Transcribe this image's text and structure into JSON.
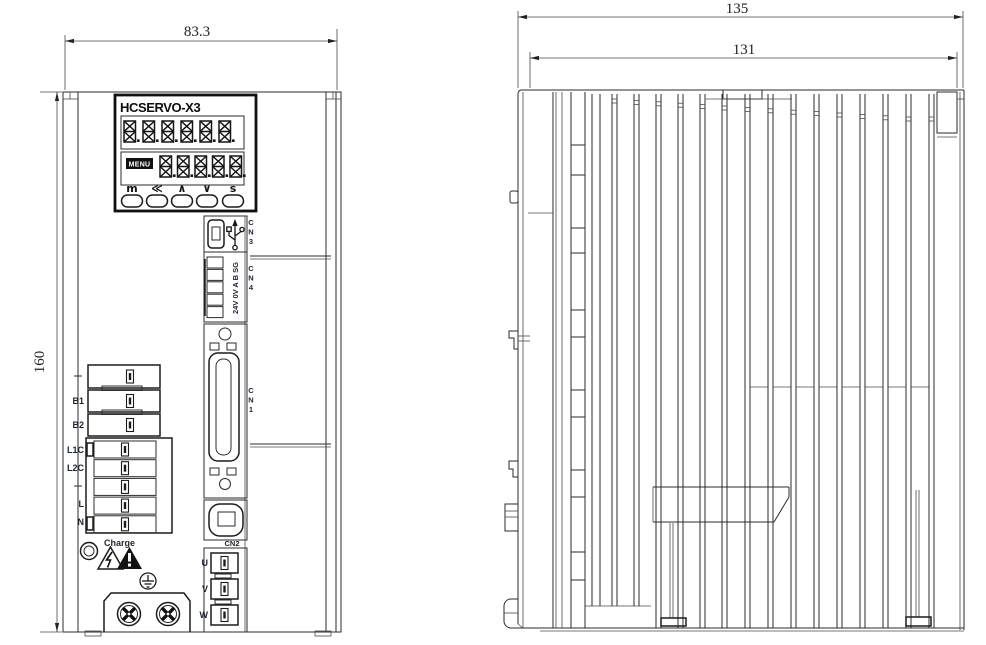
{
  "drawing": {
    "front_view": {
      "dim_width": "83.3",
      "dim_height": "160",
      "panel": {
        "model": "HCSERVO-X3",
        "menu_badge": "MENU",
        "display": {
          "row1_digits": 6,
          "row2_digits": 5
        },
        "buttons": [
          "m",
          "≪",
          "∧",
          "∨",
          "s"
        ]
      },
      "connectors": {
        "cn3": "CN3",
        "cn4": "CN4",
        "cn1": "CN1",
        "cn2": "CN2",
        "comm_pin_labels": "24V 0V A B SG"
      },
      "terminals": {
        "b1": "B1",
        "b2": "B2",
        "l1c": "L1C",
        "l2c": "L2C",
        "l": "L",
        "n": "N",
        "charge": "Charge",
        "u": "U",
        "v": "V",
        "w": "W"
      }
    },
    "side_view": {
      "dim_depth_overall": "135",
      "dim_depth_body": "131"
    }
  }
}
